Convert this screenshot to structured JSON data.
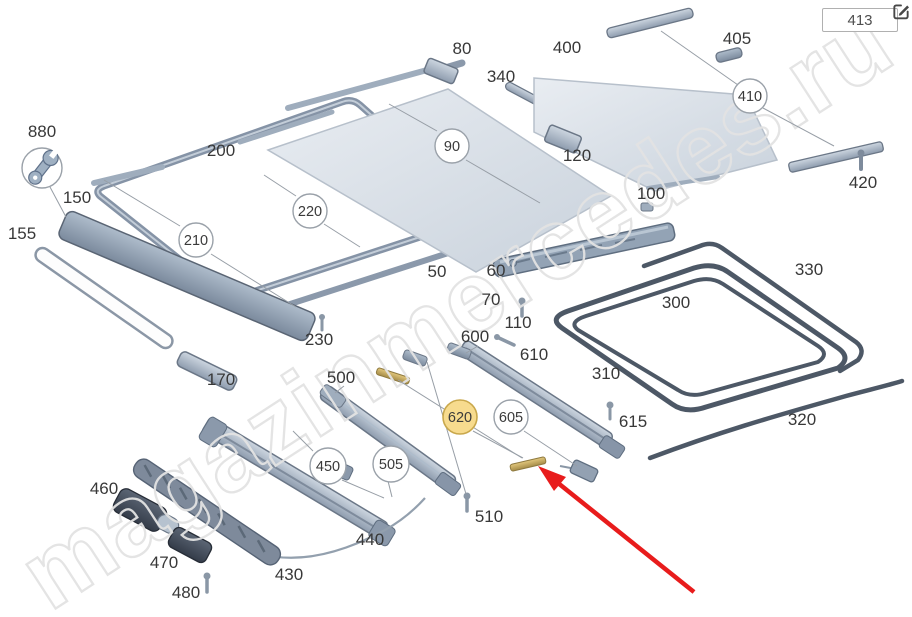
{
  "ref_box": {
    "label": "413"
  },
  "watermark": {
    "text": "magazinmercedes.ru"
  },
  "icons": {
    "edit": "edit-icon",
    "wrench": "wrench-icon",
    "arrow": "red-arrow"
  },
  "colors": {
    "highlight": "#f7db8e",
    "highlight_border": "#c9a84c",
    "arrow": "#e81c1c"
  },
  "callouts": {
    "c50": "50",
    "c60": "60",
    "c70": "70",
    "c80": "80",
    "c90": "90",
    "c100": "100",
    "c110": "110",
    "c120": "120",
    "c150": "150",
    "c155": "155",
    "c170": "170",
    "c200": "200",
    "c210": "210",
    "c220": "220",
    "c230": "230",
    "c300": "300",
    "c310": "310",
    "c320": "320",
    "c330": "330",
    "c340": "340",
    "c400": "400",
    "c405": "405",
    "c410": "410",
    "c420": "420",
    "c430": "430",
    "c440": "440",
    "c450": "450",
    "c460": "460",
    "c470": "470",
    "c480": "480",
    "c500": "500",
    "c505": "505",
    "c510": "510",
    "c600": "600",
    "c605": "605",
    "c610": "610",
    "c615": "615",
    "c620": "620",
    "c880": "880"
  }
}
